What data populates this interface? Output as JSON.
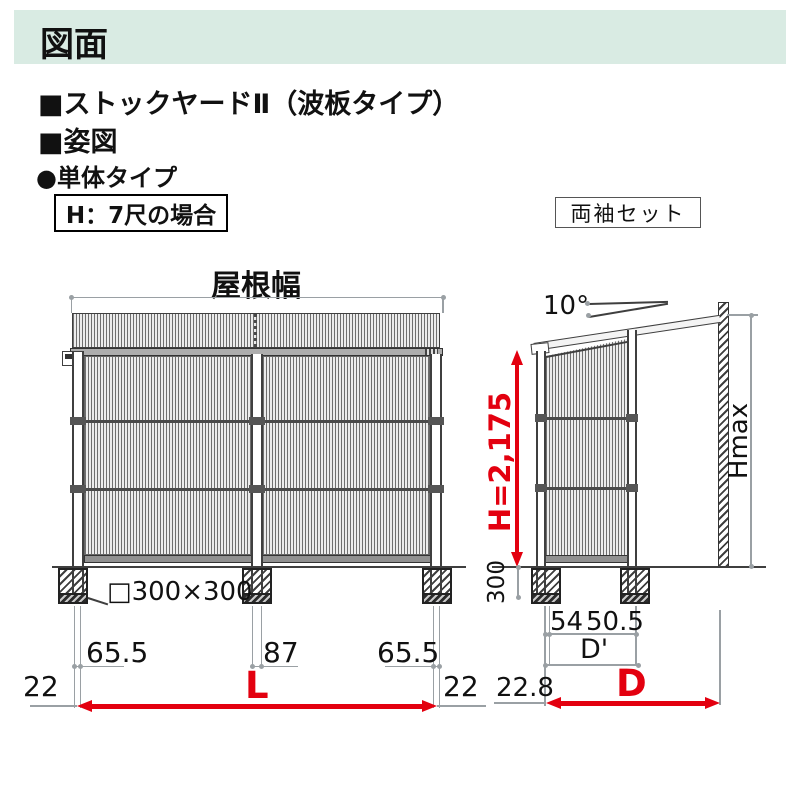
{
  "colors": {
    "header_bg": "#d9ebe3",
    "accent_red": "#e3000f",
    "line_dark": "#3f3f3f",
    "dim_gray": "#9aa0a4"
  },
  "header": {
    "title": "図面"
  },
  "headings": {
    "product": "■ストックヤードⅡ（波板タイプ）",
    "view": "■姿図",
    "unit_type": "●単体タイプ"
  },
  "tags": {
    "height_case": "H：7尺の場合",
    "sleeve_set": "両袖セット"
  },
  "front_view": {
    "roof_width_label": "屋根幅",
    "foundation_label": "□300×300",
    "dim_left": "65.5",
    "dim_center": "87",
    "dim_right": "65.5",
    "dim_end_left": "22",
    "dim_end_right": "22",
    "width_symbol": "L"
  },
  "side_view": {
    "roof_angle": "10°",
    "height_dim": "H=2,175",
    "embed_dim": "300",
    "max_height_label": "Hmax",
    "dim_post": "54",
    "dim_offset": "50.5",
    "inner_depth_symbol": "D'",
    "dim_back": "22.8",
    "depth_symbol": "D"
  }
}
